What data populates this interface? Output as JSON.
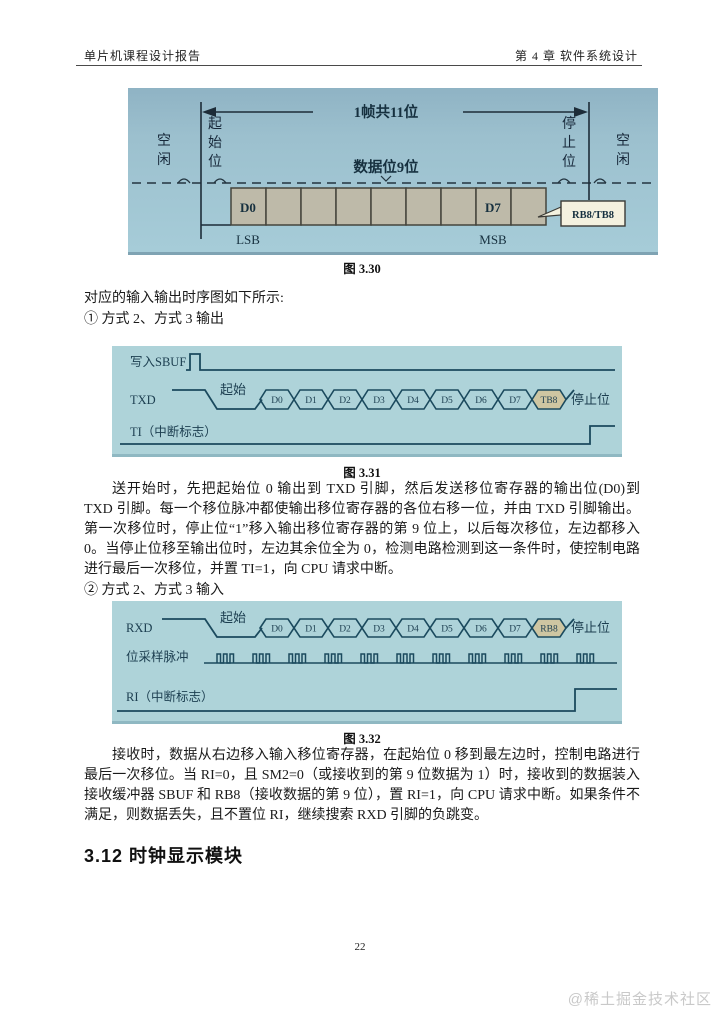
{
  "page": {
    "header_left": "单片机课程设计报告",
    "header_right": "第 4 章  软件系统设计",
    "page_number": "22",
    "watermark": "@稀土掘金技术社区"
  },
  "content": {
    "intro": "对应的输入输出时序图如下所示:",
    "item_output": "① 方式 2、方式 3 输出",
    "item_input": "② 方式 2、方式 3 输入",
    "para_output": "送开始时，先把起始位 0 输出到 TXD 引脚，然后发送移位寄存器的输出位(D0)到 TXD 引脚。每一个移位脉冲都使输出移位寄存器的各位右移一位，并由 TXD 引脚输出。第一次移位时，停止位“1”移入输出移位寄存器的第 9 位上，以后每次移位，左边都移入 0。当停止位移至输出位时，左边其余位全为 0，检测电路检测到这一条件时，使控制电路进行最后一次移位，并置 TI=1，向 CPU 请求中断。",
    "para_input": "接收时，数据从右边移入输入移位寄存器，在起始位 0 移到最左边时，控制电路进行最后一次移位。当 RI=0，且 SM2=0（或接收到的第 9 位数据为 1）时，接收到的数据装入接收缓冲器 SBUF 和 RB8（接收数据的第 9 位），置 RI=1，向 CPU 请求中断。如果条件不满足，则数据丢失，且不置位 RI，继续搜索 RXD 引脚的负跳变。",
    "section_heading": "3.12  时钟显示模块"
  },
  "fig330": {
    "caption": "图 3.30",
    "frame_label": "1帧共11位",
    "data_label": "数据位9位",
    "idle_left": "空闲",
    "idle_right": "空闲",
    "start_bit_label": "起始位",
    "stop_bit_label": "停止位",
    "d0": "D0",
    "d7": "D7",
    "lsb": "LSB",
    "msb": "MSB",
    "callout": "RB8/TB8"
  },
  "fig331": {
    "caption": "图 3.31",
    "write_sbuf": "写入SBUF",
    "txd": "TXD",
    "ti": "TI（中断标志）",
    "start": "起始",
    "stop": "停止位",
    "bits": [
      "D0",
      "D1",
      "D2",
      "D3",
      "D4",
      "D5",
      "D6",
      "D7",
      "TB8"
    ]
  },
  "fig332": {
    "caption": "图 3.32",
    "rxd": "RXD",
    "sampling": "位采样脉冲",
    "ri": "RI（中断标志）",
    "start": "起始",
    "stop": "停止位",
    "bits": [
      "D0",
      "D1",
      "D2",
      "D3",
      "D4",
      "D5",
      "D6",
      "D7",
      "RB8"
    ]
  },
  "colors": {
    "fig330_bg": "#9cc0ce",
    "fig_timing_bg": "#aed3d9",
    "diagram_line": "#1b4a5e",
    "box_fill": "#bebaa9",
    "bit_highlight": "#cec6a2",
    "callout_bg": "#f4f1df",
    "watermark": "#c9c9c9"
  }
}
